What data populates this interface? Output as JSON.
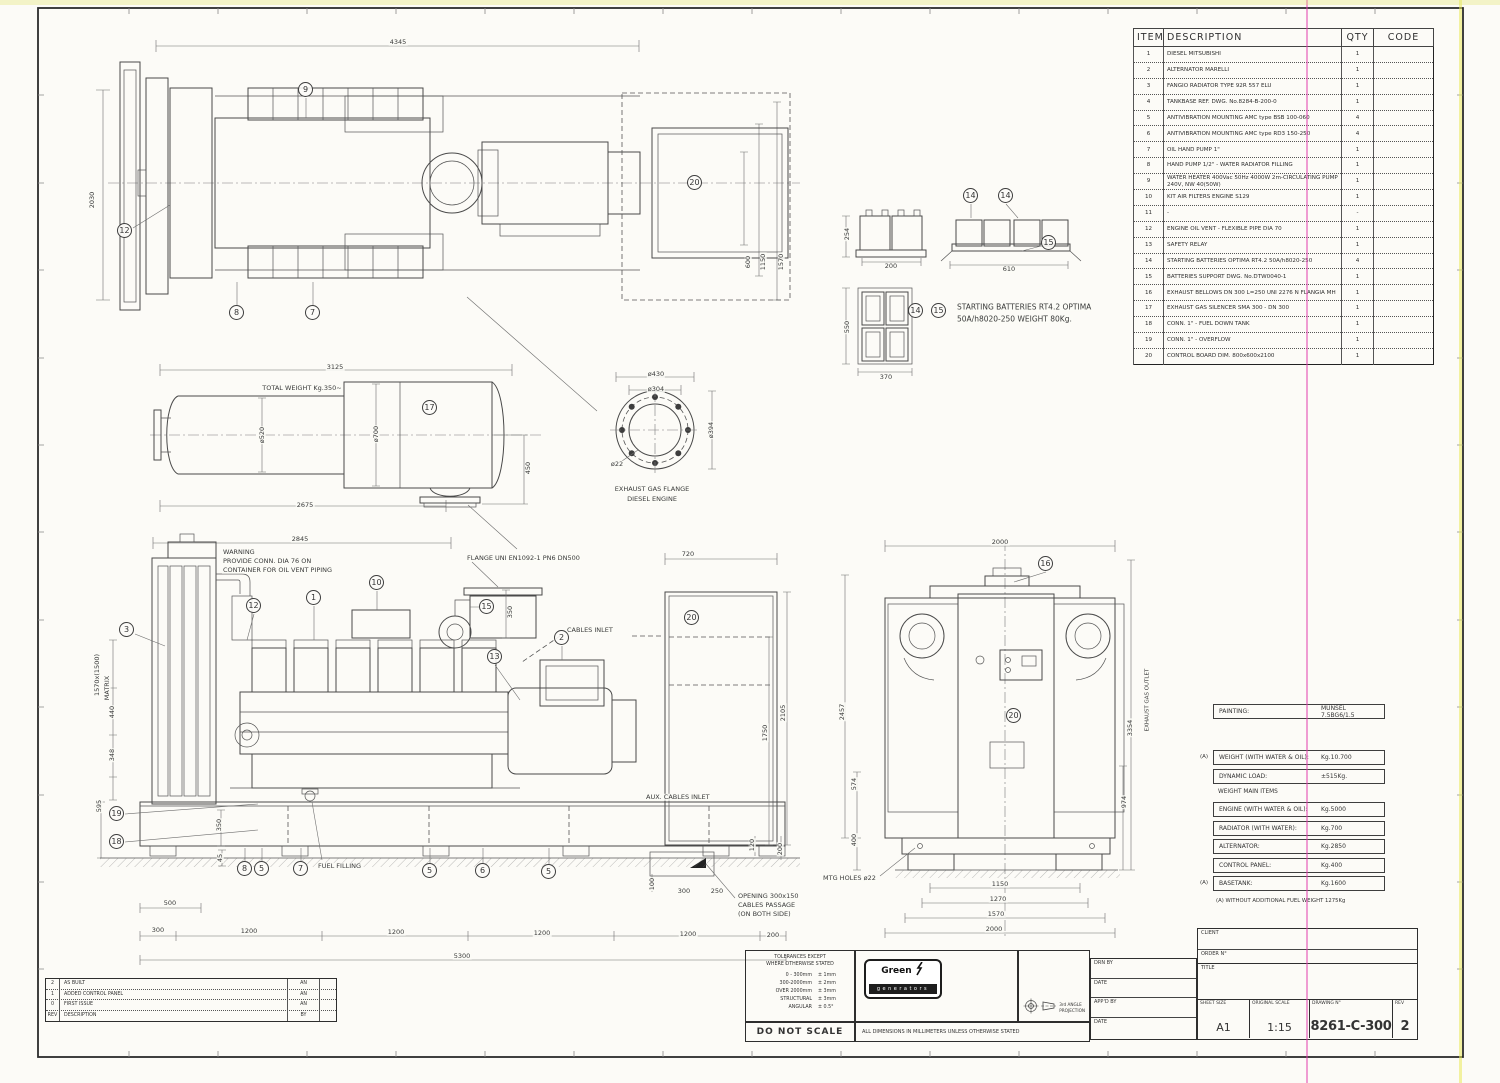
{
  "sheet": {
    "drawing_no": "8261-C-300",
    "rev": "2",
    "sheet_size": "A1",
    "scale": "1:15"
  },
  "parts_table": {
    "headers": {
      "item": "ITEM",
      "description": "DESCRIPTION",
      "qty": "QTY",
      "code": "CODE"
    },
    "rows": [
      {
        "item": "1",
        "description": "DIESEL MITSUBISHI",
        "qty": "1",
        "code": ""
      },
      {
        "item": "2",
        "description": "ALTERNATOR MARELLI",
        "qty": "1",
        "code": ""
      },
      {
        "item": "3",
        "description": "FANGIO RADIATOR TYPE 92R 557 ELU",
        "qty": "1",
        "code": ""
      },
      {
        "item": "4",
        "description": "TANKBASE REF. DWG. No.8284-B-200-0",
        "qty": "1",
        "code": ""
      },
      {
        "item": "5",
        "description": "ANTIVIBRATION MOUNTING AMC type BSB 100-060",
        "qty": "4",
        "code": ""
      },
      {
        "item": "6",
        "description": "ANTIVIBRATION MOUNTING AMC type RD3 150-250",
        "qty": "4",
        "code": ""
      },
      {
        "item": "7",
        "description": "OIL HAND PUMP 1\"",
        "qty": "1",
        "code": ""
      },
      {
        "item": "8",
        "description": "HAND PUMP 1/2\" - WATER RADIATOR FILLING",
        "qty": "1",
        "code": ""
      },
      {
        "item": "9",
        "description": "WATER HEATER 400Vac 50Hz 4000W 2m-CIRCULATING PUMP 240V, NW 40(50W)",
        "qty": "1",
        "code": ""
      },
      {
        "item": "10",
        "description": "KIT AIR FILTERS ENGINE S129",
        "qty": "1",
        "code": ""
      },
      {
        "item": "11",
        "description": "-",
        "qty": "-",
        "code": ""
      },
      {
        "item": "12",
        "description": "ENGINE OIL VENT - FLEXIBLE PIPE DIA 70",
        "qty": "1",
        "code": ""
      },
      {
        "item": "13",
        "description": "SAFETY RELAY",
        "qty": "1",
        "code": ""
      },
      {
        "item": "14",
        "description": "STARTING BATTERIES OPTIMA RT4.2 50A/h8020-250",
        "qty": "4",
        "code": ""
      },
      {
        "item": "15",
        "description": "BATTERIES SUPPORT DWG. No.DTW0040-1",
        "qty": "1",
        "code": ""
      },
      {
        "item": "16",
        "description": "EXHAUST BELLOWS DN 300 L=250  UNI 2276 N FLANGIA MH",
        "qty": "1",
        "code": ""
      },
      {
        "item": "17",
        "description": "EXHAUST GAS SILENCER SMA 300 - DN 300",
        "qty": "1",
        "code": ""
      },
      {
        "item": "18",
        "description": "CONN. 1\" - FUEL DOWN TANK",
        "qty": "1",
        "code": ""
      },
      {
        "item": "19",
        "description": "CONN. 1\" - OVERFLOW",
        "qty": "1",
        "code": ""
      },
      {
        "item": "20",
        "description": "CONTROL BOARD DIM. 800x600x2100",
        "qty": "1",
        "code": ""
      }
    ]
  },
  "weights": {
    "painting_label": "PAINTING:",
    "painting_value": "MUNSEL 7.5BG6/1.5",
    "prefix_a": "(A)",
    "top_rows": [
      {
        "label": "WEIGHT (WITH WATER & OIL):",
        "value": "Kg.10.700"
      },
      {
        "label": "DYNAMIC LOAD:",
        "value": "±515Kg."
      }
    ],
    "main_title": "WEIGHT MAIN ITEMS",
    "main_rows": [
      {
        "label": "ENGINE (WITH WATER & OIL):",
        "value": "Kg.5000"
      },
      {
        "label": "RADIATOR (WITH WATER):",
        "value": "Kg.700"
      },
      {
        "label": "ALTERNATOR:",
        "value": "Kg.2850"
      },
      {
        "label": "CONTROL PANEL:",
        "value": "Kg.400"
      },
      {
        "label": "BASETANK:",
        "value": "Kg.1600"
      }
    ],
    "footnote": "(A) WITHOUT ADDITIONAL FUEL WEIGHT 1275Kg"
  },
  "title_block": {
    "client_label": "CLIENT",
    "order_label": "ORDER N°",
    "title_label": "TITLE",
    "drn_label": "DRN BY",
    "date_label": "DATE",
    "appd_label": "APP'D BY",
    "date2_label": "DATE",
    "sheet_size_label": "SHEET SIZE",
    "sheet_size": "A1",
    "scale_label": "ORIGINAL SCALE",
    "scale": "1:15",
    "drawing_no_label": "DRAWING N°",
    "drawing_no": "8261-C-300",
    "rev_label": "REV",
    "rev": "2"
  },
  "tolerances": {
    "title1": "TOLERANCES EXCEPT",
    "title2": "WHERE OTHERWISE STATED",
    "rows": [
      {
        "range": "0 - 300mm",
        "tol": "± 1mm"
      },
      {
        "range": "300-2000mm",
        "tol": "± 2mm"
      },
      {
        "range": "OVER 2000mm",
        "tol": "± 3mm"
      },
      {
        "range": "STRUCTURAL",
        "tol": "± 3mm"
      },
      {
        "range": "ANGULAR",
        "tol": "± 0.5°"
      }
    ]
  },
  "notes": {
    "do_not_scale": "DO NOT SCALE",
    "dims_note": "ALL DIMENSIONS IN MILLIMETERS UNLESS OTHERWISE STATED",
    "projection_note_1": "3rd ANGLE",
    "projection_note_2": "PROJECTION"
  },
  "logo": {
    "word1": "Green",
    "word2": "Power",
    "sub": "generators"
  },
  "revisions": {
    "rows": [
      {
        "rev": "2",
        "desc": "AS BUILT",
        "by": "AN",
        "x": ""
      },
      {
        "rev": "1",
        "desc": "ADDED CONTROL PANEL",
        "by": "AN",
        "x": ""
      },
      {
        "rev": "0",
        "desc": "FIRST ISSUE",
        "by": "AN",
        "x": ""
      },
      {
        "rev": "REV",
        "desc": "DESCRIPTION",
        "by": "BY",
        "x": ""
      }
    ]
  },
  "colors": {
    "linework": "#4a4a4a",
    "scan_magenta": "#e23ead",
    "scan_yellow": "#e9e95a",
    "paper": "#fcfbf7"
  },
  "annotations": [
    {
      "t": "4345",
      "x": 398,
      "y": 42
    },
    {
      "t": "2030",
      "x": 92,
      "y": 200,
      "r": 1
    },
    {
      "t": "600",
      "x": 748,
      "y": 262,
      "r": 1
    },
    {
      "t": "1150",
      "x": 763,
      "y": 262,
      "r": 1
    },
    {
      "t": "1570",
      "x": 781,
      "y": 262,
      "r": 1
    },
    {
      "t": "3125",
      "x": 335,
      "y": 367
    },
    {
      "t": "TOTAL WEIGHT Kg.350~",
      "x": 302,
      "y": 388,
      "n": "silencer-weight-note"
    },
    {
      "t": "ø520",
      "x": 262,
      "y": 435,
      "r": 1
    },
    {
      "t": "ø700",
      "x": 376,
      "y": 434,
      "r": 1
    },
    {
      "t": "450",
      "x": 528,
      "y": 468,
      "r": 1
    },
    {
      "t": "2675",
      "x": 305,
      "y": 505
    },
    {
      "t": "ø430",
      "x": 656,
      "y": 374
    },
    {
      "t": "ø304",
      "x": 656,
      "y": 389
    },
    {
      "t": "ø394",
      "x": 711,
      "y": 430,
      "r": 1
    },
    {
      "t": "ø22",
      "x": 617,
      "y": 464
    },
    {
      "t": "EXHAUST GAS FLANGE",
      "x": 652,
      "y": 489,
      "n": "flange-caption"
    },
    {
      "t": "DIESEL ENGINE",
      "x": 652,
      "y": 499,
      "n": "flange-caption"
    },
    {
      "t": "254",
      "x": 847,
      "y": 234,
      "r": 1
    },
    {
      "t": "200",
      "x": 891,
      "y": 266
    },
    {
      "t": "610",
      "x": 1009,
      "y": 269
    },
    {
      "t": "550",
      "x": 847,
      "y": 327,
      "r": 1
    },
    {
      "t": "370",
      "x": 886,
      "y": 377
    },
    {
      "t": "STARTING BATTERIES RT4.2 OPTIMA",
      "x": 956,
      "y": 307,
      "a": "l",
      "s": 7.5,
      "n": "batteries-note"
    },
    {
      "t": "50A/h8020-250 WEIGHT 80Kg.",
      "x": 956,
      "y": 319,
      "a": "l",
      "s": 7.5,
      "n": "batteries-note"
    },
    {
      "t": "2845",
      "x": 300,
      "y": 539
    },
    {
      "t": "WARNING",
      "x": 222,
      "y": 552,
      "a": "l",
      "n": "warning-note"
    },
    {
      "t": "PROVIDE CONN. DIA 76 ON",
      "x": 222,
      "y": 561,
      "a": "l",
      "n": "warning-note"
    },
    {
      "t": "CONTAINER FOR OIL VENT PIPING",
      "x": 222,
      "y": 570,
      "a": "l",
      "n": "warning-note"
    },
    {
      "t": "FLANGE UNI EN1092-1 PN6 DN500",
      "x": 466,
      "y": 558,
      "a": "l",
      "n": "flange-note"
    },
    {
      "t": "350",
      "x": 510,
      "y": 612,
      "r": 1
    },
    {
      "t": "CABLES INLET",
      "x": 566,
      "y": 630,
      "a": "l",
      "n": "cables-inlet-note"
    },
    {
      "t": "720",
      "x": 688,
      "y": 554
    },
    {
      "t": "2105",
      "x": 783,
      "y": 713,
      "r": 1
    },
    {
      "t": "1750",
      "x": 765,
      "y": 733,
      "r": 1
    },
    {
      "t": "120",
      "x": 752,
      "y": 845,
      "r": 1
    },
    {
      "t": "200",
      "x": 780,
      "y": 849,
      "r": 1
    },
    {
      "t": "AUX. CABLES INLET",
      "x": 645,
      "y": 797,
      "a": "l",
      "n": "aux-cables-note"
    },
    {
      "t": "OPENING 300x150",
      "x": 737,
      "y": 896,
      "a": "l",
      "n": "opening-note"
    },
    {
      "t": "CABLES PASSAGE",
      "x": 737,
      "y": 905,
      "a": "l",
      "n": "opening-note"
    },
    {
      "t": "(ON BOTH SIDE)",
      "x": 737,
      "y": 914,
      "a": "l",
      "n": "opening-note"
    },
    {
      "t": "100",
      "x": 652,
      "y": 884,
      "r": 1
    },
    {
      "t": "300",
      "x": 684,
      "y": 891
    },
    {
      "t": "250",
      "x": 717,
      "y": 891
    },
    {
      "t": "FUEL FILLING",
      "x": 317,
      "y": 866,
      "a": "l",
      "n": "fuel-filling-label"
    },
    {
      "t": "1570x(1500)",
      "x": 97,
      "y": 675,
      "r": 1
    },
    {
      "t": "MATRIX",
      "x": 107,
      "y": 688,
      "r": 1
    },
    {
      "t": "440",
      "x": 112,
      "y": 712,
      "r": 1
    },
    {
      "t": "348",
      "x": 112,
      "y": 755,
      "r": 1
    },
    {
      "t": "595",
      "x": 99,
      "y": 806,
      "r": 1
    },
    {
      "t": "350",
      "x": 219,
      "y": 825,
      "r": 1
    },
    {
      "t": "45",
      "x": 220,
      "y": 858,
      "r": 1
    },
    {
      "t": "500",
      "x": 170,
      "y": 903
    },
    {
      "t": "300",
      "x": 158,
      "y": 930
    },
    {
      "t": "1200",
      "x": 249,
      "y": 931
    },
    {
      "t": "1200",
      "x": 396,
      "y": 932
    },
    {
      "t": "1200",
      "x": 542,
      "y": 933
    },
    {
      "t": "1200",
      "x": 688,
      "y": 934
    },
    {
      "t": "200",
      "x": 773,
      "y": 935
    },
    {
      "t": "5300",
      "x": 462,
      "y": 956
    },
    {
      "t": "2000",
      "x": 1000,
      "y": 542
    },
    {
      "t": "2457",
      "x": 842,
      "y": 712,
      "r": 1
    },
    {
      "t": "3354",
      "x": 1130,
      "y": 728,
      "r": 1
    },
    {
      "t": "EXHAUST GAS OUTLET",
      "x": 1148,
      "y": 700,
      "r": 1,
      "s": 5.5,
      "n": "exhaust-outlet-label"
    },
    {
      "t": "574",
      "x": 854,
      "y": 784,
      "r": 1
    },
    {
      "t": "400",
      "x": 854,
      "y": 840,
      "r": 1
    },
    {
      "t": "974",
      "x": 1124,
      "y": 802,
      "r": 1
    },
    {
      "t": "MTG HOLES ø22",
      "x": 822,
      "y": 878,
      "a": "l",
      "n": "mtg-holes-note"
    },
    {
      "t": "1150",
      "x": 1000,
      "y": 884
    },
    {
      "t": "1270",
      "x": 998,
      "y": 899
    },
    {
      "t": "1570",
      "x": 996,
      "y": 914
    },
    {
      "t": "2000",
      "x": 994,
      "y": 929
    }
  ],
  "balloons": [
    {
      "n": "9",
      "x": 306,
      "y": 90
    },
    {
      "n": "12",
      "x": 125,
      "y": 231
    },
    {
      "n": "8",
      "x": 237,
      "y": 313
    },
    {
      "n": "7",
      "x": 313,
      "y": 313
    },
    {
      "n": "20",
      "x": 695,
      "y": 183
    },
    {
      "n": "17",
      "x": 430,
      "y": 408
    },
    {
      "n": "14",
      "x": 971,
      "y": 196
    },
    {
      "n": "14",
      "x": 1006,
      "y": 196
    },
    {
      "n": "15",
      "x": 1049,
      "y": 243
    },
    {
      "n": "14",
      "x": 916,
      "y": 311
    },
    {
      "n": "15",
      "x": 939,
      "y": 311
    },
    {
      "n": "3",
      "x": 127,
      "y": 630
    },
    {
      "n": "12",
      "x": 254,
      "y": 606
    },
    {
      "n": "1",
      "x": 314,
      "y": 598
    },
    {
      "n": "10",
      "x": 377,
      "y": 583
    },
    {
      "n": "15",
      "x": 487,
      "y": 607
    },
    {
      "n": "13",
      "x": 495,
      "y": 657
    },
    {
      "n": "2",
      "x": 562,
      "y": 638
    },
    {
      "n": "20",
      "x": 692,
      "y": 618
    },
    {
      "n": "19",
      "x": 117,
      "y": 814
    },
    {
      "n": "18",
      "x": 117,
      "y": 842
    },
    {
      "n": "8",
      "x": 245,
      "y": 869
    },
    {
      "n": "5",
      "x": 262,
      "y": 869
    },
    {
      "n": "7",
      "x": 301,
      "y": 869
    },
    {
      "n": "5",
      "x": 430,
      "y": 871
    },
    {
      "n": "6",
      "x": 483,
      "y": 871
    },
    {
      "n": "5",
      "x": 549,
      "y": 872
    },
    {
      "n": "16",
      "x": 1046,
      "y": 564
    },
    {
      "n": "20",
      "x": 1014,
      "y": 716
    }
  ]
}
